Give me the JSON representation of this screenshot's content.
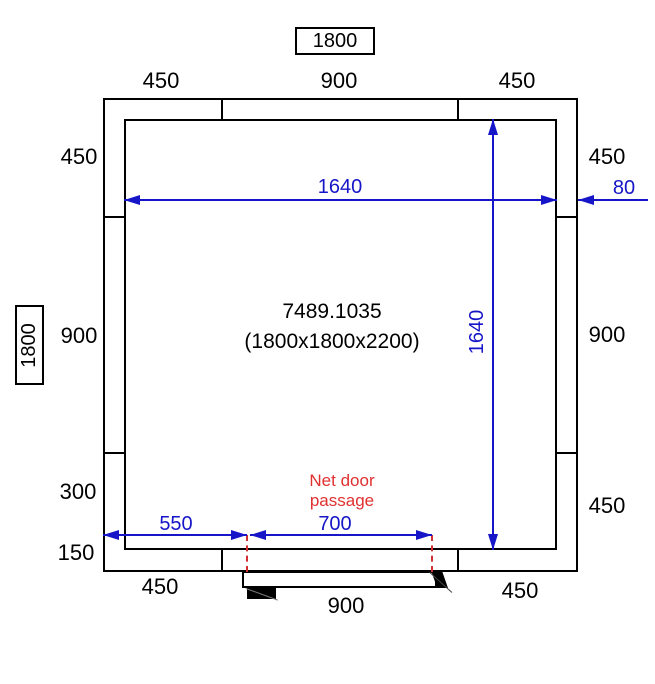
{
  "title": {
    "overall_width_boxed": "1800",
    "overall_depth_boxed": "1800"
  },
  "center": {
    "product_code": "7489.1035",
    "product_size": "(1800x1800x2200)"
  },
  "dims": {
    "top": [
      "450",
      "900",
      "450"
    ],
    "left": [
      "450",
      "900",
      "300",
      "150"
    ],
    "right": [
      "450",
      "900",
      "450"
    ],
    "bottom": [
      "450",
      "900",
      "450"
    ]
  },
  "blue_dims": {
    "inner_width": "1640",
    "inner_height": "1640",
    "wall_thickness": "80",
    "door_offset": "550",
    "door_passage_width": "700"
  },
  "annotations": {
    "door_note_line1": "Net door",
    "door_note_line2": "passage"
  },
  "colors": {
    "dimension_blue": "#1616c8",
    "annotation_red": "#e03030",
    "line_black": "#000000"
  }
}
